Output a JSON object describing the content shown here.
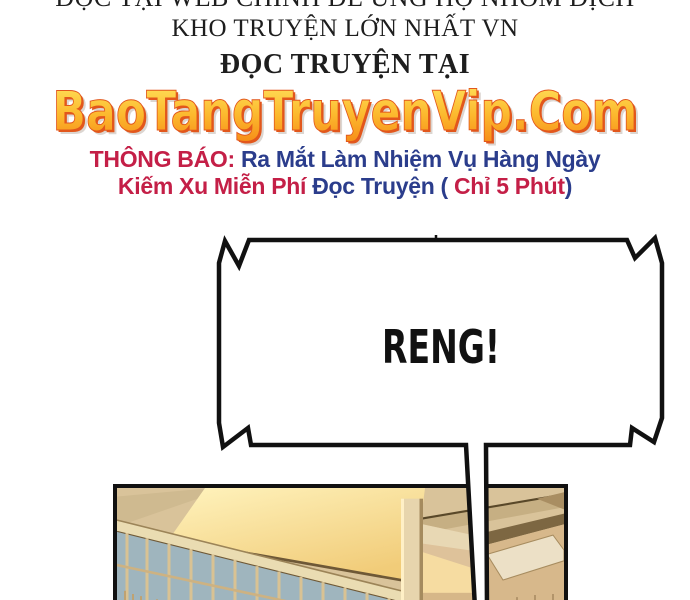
{
  "page": {
    "background": "#ffffff",
    "width": 690,
    "height": 600
  },
  "header": {
    "line1": "ĐỌC TẠI WEB CHÍNH ĐỂ ỦNG HỘ NHÓM DỊCH",
    "line2": "KHO TRUYỆN LỚN NHẤT VN",
    "line3": "ĐỌC TRUYỆN TẠI",
    "text_color": "#1e1e1e"
  },
  "site_title": {
    "text": "BaoTangTruyenVip.Com",
    "gradient_top": "#ffe45e",
    "gradient_bottom": "#f68c17",
    "outline_color": "#e2571c"
  },
  "announcement": {
    "label": "THÔNG BÁO: ",
    "line1_rest": "Ra Mắt Làm Nhiệm Vụ Hàng Ngày",
    "line2_part1": "Kiếm Xu Miễn Phí ",
    "line2_part2": "Đọc Truyện ( ",
    "line2_part3": "Chỉ 5 Phút",
    "line2_part4": ")",
    "red_color": "#c41f47",
    "blue_color": "#2b3d8c"
  },
  "speech_bubble": {
    "text": "RENG!",
    "stroke_color": "#111111",
    "fill_color": "#ffffff"
  },
  "panel": {
    "border_color": "#111111",
    "colors": {
      "wall": "#d9c39a",
      "cove_light": "#ffeeae",
      "window_glass": "#9fb5be",
      "column": "#e7d5ad",
      "beam_dark": "#6e5836",
      "skylight": "#ece0c6"
    }
  }
}
